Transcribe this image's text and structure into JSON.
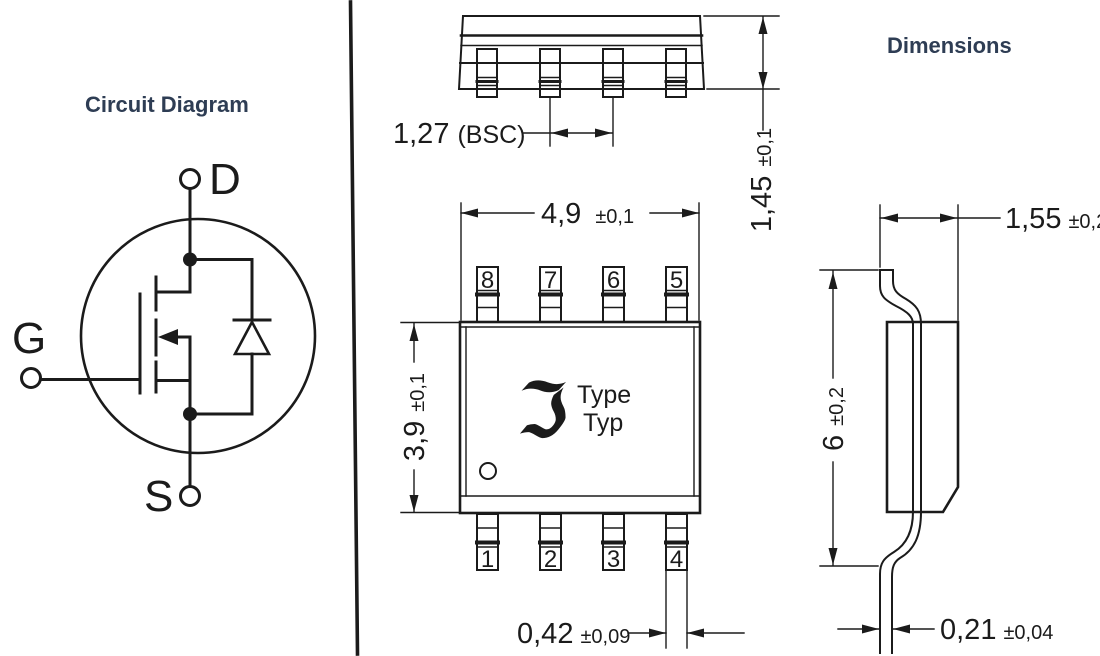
{
  "figure": {
    "left": {
      "title": "Circuit Diagram",
      "terminals": {
        "drain": "D",
        "gate": "G",
        "source": "S"
      }
    },
    "right": {
      "title": "Dimensions",
      "package_marking": {
        "logo_glyph": "ℑ",
        "line1": "Type",
        "line2": "Typ"
      },
      "pins_top": [
        "8",
        "7",
        "6",
        "5"
      ],
      "pins_bottom": [
        "1",
        "2",
        "3",
        "4"
      ],
      "dims": {
        "pin_pitch": {
          "value": "1,27",
          "tol": "(BSC)"
        },
        "package_height": {
          "value": "1,45",
          "tol": "±0,1"
        },
        "body_width": {
          "value": "4,9",
          "tol": "±0,1"
        },
        "body_length": {
          "value": "3,9",
          "tol": "±0,1"
        },
        "shoulder_width": {
          "value": "1,55",
          "tol": "±0,2"
        },
        "overall_span": {
          "value": "6",
          "tol": "±0,2"
        },
        "lead_width": {
          "value": "0,42",
          "tol": "±0,09"
        },
        "lead_thickness": {
          "value": "0,21",
          "tol": "±0,04"
        }
      },
      "colors": {
        "ink": "#1b1b1b",
        "title_navy": "#2e3d54"
      }
    }
  }
}
